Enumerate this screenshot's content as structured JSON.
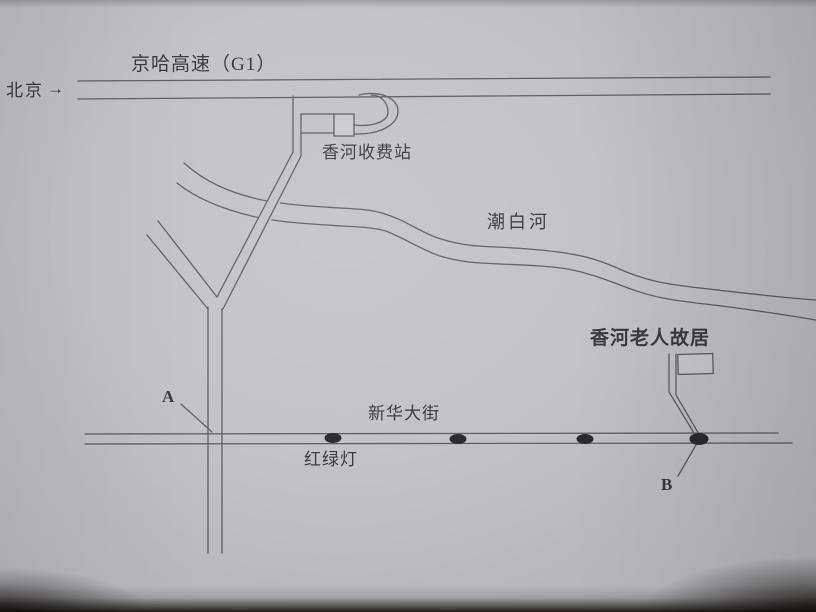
{
  "colors": {
    "paper": "#c2c2c6",
    "line": "#5c5c61",
    "text": "#36363a",
    "dot": "#26262a",
    "building_fill": "#c9c9cd"
  },
  "map": {
    "expressway": {
      "label": "京哈高速（G1）"
    },
    "origin": {
      "label": "北京",
      "arrow": "→"
    },
    "toll_station": {
      "label": "香河收费站"
    },
    "river": {
      "label": "潮白河"
    },
    "residence": {
      "label": "香河老人故居"
    },
    "street": {
      "label": "新华大街"
    },
    "traffic_light": {
      "label": "红绿灯",
      "count": 4
    },
    "points": {
      "a": "A",
      "b": "B"
    }
  }
}
